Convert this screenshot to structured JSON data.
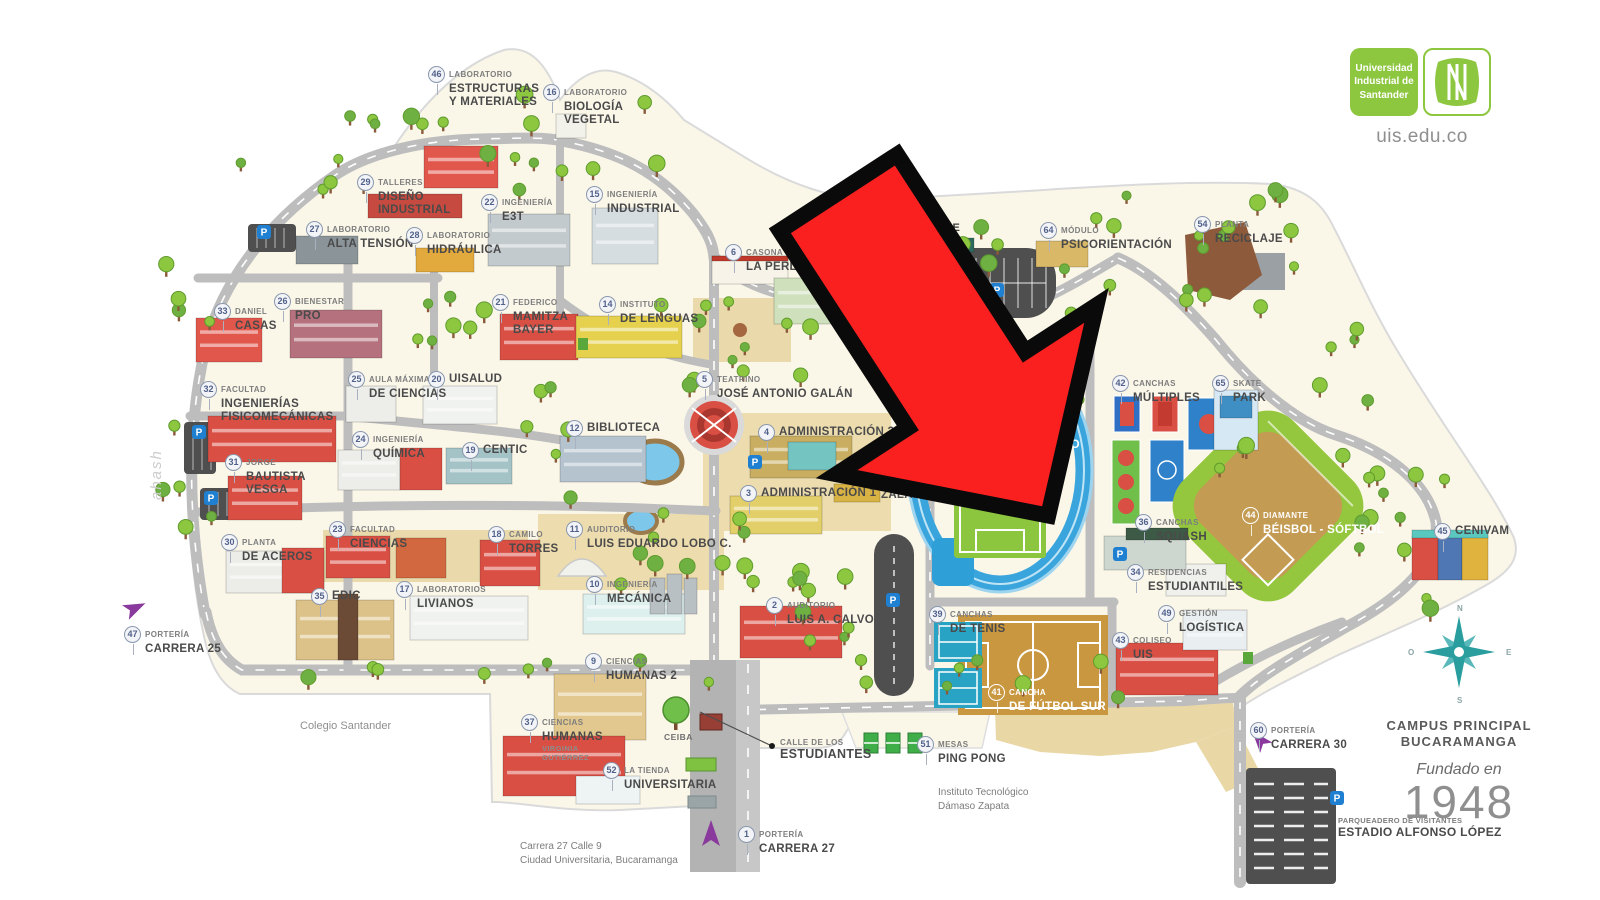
{
  "branding": {
    "org_lines": [
      "Universidad",
      "Industrial de",
      "Santander"
    ],
    "monogram": "UIS",
    "domain": "uis.edu.co"
  },
  "corner": {
    "campus_line1": "CAMPUS PRINCIPAL",
    "campus_line2": "BUCARAMANGA",
    "founded_label": "Fundado en",
    "founded_year": "1948",
    "compass": {
      "n": "N",
      "s": "S",
      "e": "E",
      "o": "O"
    }
  },
  "icons": {
    "parking": "P"
  },
  "colors": {
    "accent_green": "#8dc63f",
    "arrow_red": "#fb2020",
    "land": "#faf7e9",
    "road": "#bdbdbd",
    "compass_teal": "#2a9d9f",
    "portal_purple": "#8a3a9c",
    "badge_text": "#51618a"
  },
  "map_labels": [
    {
      "num": "46",
      "pre": "LABORATORIO",
      "name": [
        "ESTRUCTURAS",
        "Y MATERIALES"
      ],
      "x": 428,
      "y": 66
    },
    {
      "num": "16",
      "pre": "LABORATORIO",
      "name": [
        "BIOLOGÍA",
        "VEGETAL"
      ],
      "x": 543,
      "y": 84
    },
    {
      "num": "29",
      "pre": "TALLERES",
      "name": [
        "DISEÑO",
        "INDUSTRIAL"
      ],
      "x": 357,
      "y": 174
    },
    {
      "num": "22",
      "pre": "INGENIERÍA",
      "name": [
        "E3T"
      ],
      "x": 481,
      "y": 194
    },
    {
      "num": "15",
      "pre": "INGENIERÍA",
      "name": [
        "INDUSTRIAL"
      ],
      "x": 586,
      "y": 186
    },
    {
      "num": "27",
      "pre": "LABORATORIO",
      "name": [
        "ALTA TENSIÓN"
      ],
      "x": 306,
      "y": 221
    },
    {
      "num": "28",
      "pre": "LABORATORIO",
      "name": [
        "HIDRÁULICA"
      ],
      "x": 406,
      "y": 227
    },
    {
      "num": "33",
      "pre": "DANIEL",
      "name": [
        "CASAS"
      ],
      "x": 214,
      "y": 303
    },
    {
      "num": "26",
      "pre": "BIENESTAR",
      "name": [
        "PRO"
      ],
      "x": 274,
      "y": 293
    },
    {
      "num": "21",
      "pre": "FEDERICO",
      "name": [
        "MAMITZA",
        "BAYER"
      ],
      "x": 492,
      "y": 294
    },
    {
      "num": "14",
      "pre": "INSTITUTO",
      "name": [
        "DE LENGUAS"
      ],
      "x": 599,
      "y": 296
    },
    {
      "num": "6",
      "pre": "CASONA",
      "name": [
        "LA PERLA"
      ],
      "x": 725,
      "y": 244
    },
    {
      "num": "7",
      "pre": "B",
      "name": [
        "E"
      ],
      "x": 816,
      "y": 270
    },
    {
      "num": "64",
      "pre": "MÓDULO",
      "name": [
        "PSICORIENTACIÓN"
      ],
      "x": 1040,
      "y": 222
    },
    {
      "num": "54",
      "pre": "PLANTA",
      "name": [
        "RECICLAJE"
      ],
      "x": 1194,
      "y": 216
    },
    {
      "num": "32",
      "pre": "FACULTAD",
      "name": [
        "INGENIERÍAS",
        "FISICOMECÁNICAS"
      ],
      "x": 200,
      "y": 381
    },
    {
      "num": "25",
      "pre": "AULA MÁXIMA",
      "name": [
        "DE CIENCIAS"
      ],
      "x": 348,
      "y": 371
    },
    {
      "num": "20",
      "name": [
        "UISALUD"
      ],
      "x": 428,
      "y": 371
    },
    {
      "num": "24",
      "pre": "INGENIERÍA",
      "name": [
        "QUÍMICA"
      ],
      "x": 352,
      "y": 431
    },
    {
      "num": "19",
      "name": [
        "CENTIC"
      ],
      "x": 462,
      "y": 442
    },
    {
      "num": "31",
      "pre": "JORGE",
      "name": [
        "BAUTISTA",
        "VESGA"
      ],
      "x": 225,
      "y": 454
    },
    {
      "num": "5",
      "pre": "TEATRINO",
      "name": [
        "JOSÉ ANTONIO GALÁN"
      ],
      "x": 696,
      "y": 371
    },
    {
      "num": "12",
      "name": [
        "BIBLIOTECA"
      ],
      "x": 566,
      "y": 420
    },
    {
      "num": "4",
      "name": [
        "ADMINISTRACIÓN 3"
      ],
      "x": 758,
      "y": 424
    },
    {
      "num": "63",
      "pre": "AUDITORIO",
      "name": [
        "JORGE",
        "ZALAMEA"
      ],
      "x": 860,
      "y": 459
    },
    {
      "num": "3",
      "name": [
        "ADMINISTRACIÓN 1"
      ],
      "x": 740,
      "y": 485
    },
    {
      "num": "40",
      "pre": "ESTADIO",
      "name": [
        "1° DE MARZO"
      ],
      "x": 980,
      "y": 422,
      "white": true
    },
    {
      "num": "42",
      "pre": "CANCHAS",
      "name": [
        "MÚLTIPLES"
      ],
      "x": 1112,
      "y": 375
    },
    {
      "num": "65",
      "pre": "SKATE",
      "name": [
        "PARK"
      ],
      "x": 1212,
      "y": 375
    },
    {
      "num": "36",
      "pre": "CANCHAS",
      "name": [
        "SQUASH"
      ],
      "x": 1135,
      "y": 514
    },
    {
      "num": "44",
      "pre": "DIAMANTE",
      "name": [
        "BÉISBOL - SÓFTBOL"
      ],
      "x": 1242,
      "y": 507,
      "white": true
    },
    {
      "num": "45",
      "name": [
        "CENIVAM"
      ],
      "x": 1434,
      "y": 523
    },
    {
      "num": "34",
      "pre": "RESIDENCIAS",
      "name": [
        "ESTUDIANTILES"
      ],
      "x": 1127,
      "y": 564
    },
    {
      "num": "49",
      "pre": "GESTIÓN",
      "name": [
        "LOGÍSTICA"
      ],
      "x": 1158,
      "y": 605
    },
    {
      "num": "43",
      "pre": "COLISEO",
      "name": [
        "UIS"
      ],
      "x": 1112,
      "y": 632
    },
    {
      "num": "30",
      "pre": "PLANTA",
      "name": [
        "DE ACEROS"
      ],
      "x": 221,
      "y": 534
    },
    {
      "num": "23",
      "pre": "FACULTAD",
      "name": [
        "CIENCIAS"
      ],
      "x": 329,
      "y": 521
    },
    {
      "num": "35",
      "name": [
        "EDIC"
      ],
      "x": 311,
      "y": 588
    },
    {
      "num": "17",
      "pre": "LABORATORIOS",
      "name": [
        "LIVIANOS"
      ],
      "x": 396,
      "y": 581
    },
    {
      "num": "18",
      "pre": "CAMILO",
      "name": [
        "TORRES"
      ],
      "x": 488,
      "y": 526
    },
    {
      "num": "11",
      "pre": "AUDITORIO",
      "name": [
        "LUIS EDUARDO LOBO C."
      ],
      "x": 566,
      "y": 521
    },
    {
      "num": "10",
      "pre": "INGENIERÍA",
      "name": [
        "MECÁNICA"
      ],
      "x": 586,
      "y": 576
    },
    {
      "num": "9",
      "pre": "CIENCIAS",
      "name": [
        "HUMANAS 2"
      ],
      "x": 585,
      "y": 653
    },
    {
      "num": "2",
      "pre": "AUDITORIO",
      "name": [
        "LUIS A. CALVO"
      ],
      "x": 766,
      "y": 597
    },
    {
      "num": "39",
      "pre": "CANCHAS",
      "name": [
        "DE TENIS"
      ],
      "x": 929,
      "y": 606
    },
    {
      "num": "41",
      "pre": "CANCHA",
      "name": [
        "DE FÚTBOL SUR"
      ],
      "x": 988,
      "y": 684,
      "white": true
    },
    {
      "num": "47",
      "pre": "PORTERÍA",
      "name": [
        "CARRERA 25"
      ],
      "x": 124,
      "y": 626
    },
    {
      "num": "37",
      "pre": "CIENCIAS",
      "name": [
        "HUMANAS"
      ],
      "sub": [
        "VIRGINIA",
        "GUTIÉRREZ"
      ],
      "x": 521,
      "y": 714
    },
    {
      "num": "52",
      "pre": "LA TIENDA",
      "name": [
        "UNIVERSITARIA"
      ],
      "x": 603,
      "y": 762
    },
    {
      "num": "1",
      "pre": "PORTERÍA",
      "name": [
        "CARRERA 27"
      ],
      "x": 738,
      "y": 826
    },
    {
      "num": "51",
      "pre": "MESAS",
      "name": [
        "PING PONG"
      ],
      "x": 917,
      "y": 736
    },
    {
      "num": "60",
      "pre": "PORTERÍA",
      "name": [
        "CARRERA 30"
      ],
      "x": 1250,
      "y": 722
    }
  ],
  "notes": [
    {
      "id": "ceiba",
      "lines": [
        "CEIBA"
      ],
      "x": 664,
      "y": 732
    },
    {
      "id": "calle",
      "lines": [
        "CALLE DE LOS",
        "ESTUDIANTES"
      ],
      "x": 780,
      "y": 738
    },
    {
      "id": "colegio",
      "lines": [
        "Colegio Santander"
      ],
      "x": 300,
      "y": 720
    },
    {
      "id": "instituto",
      "lines": [
        "Instituto Tecnológico",
        "Dámaso Zapata"
      ],
      "x": 938,
      "y": 786
    },
    {
      "id": "address",
      "lines": [
        "Carrera 27 Calle 9",
        "Ciudad Universitaria, Bucaramanga"
      ],
      "x": 520,
      "y": 840
    },
    {
      "id": "parqueadero",
      "lines": [
        "PARQUEADERO DE VISITANTES",
        "ESTADIO ALFONSO LÓPEZ"
      ],
      "x": 1338,
      "y": 816
    },
    {
      "id": "re",
      "lines": [
        "RE"
      ],
      "x": 944,
      "y": 222
    },
    {
      "id": "signature",
      "lines": [
        "ahash"
      ],
      "x": 148,
      "y": 500
    }
  ]
}
